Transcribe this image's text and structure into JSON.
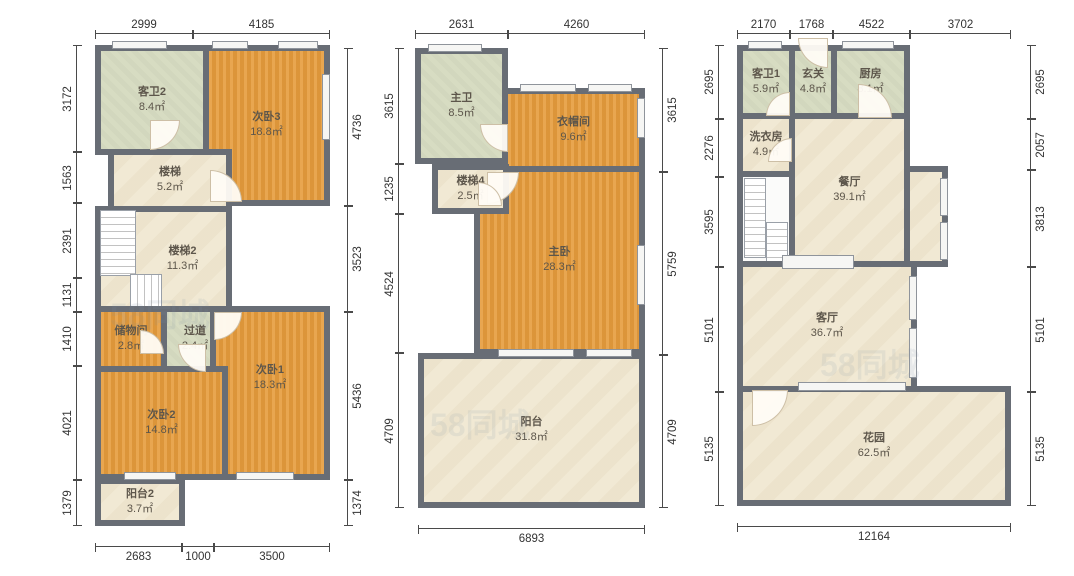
{
  "watermark": "58同城",
  "colors": {
    "wall": "#686d75",
    "bedroom": "#e69c3c",
    "bath": "#d7dcc2",
    "living": "#f1e9d4",
    "dim_text": "#333333"
  },
  "plans": [
    {
      "name": "left-floor",
      "rooms": [
        {
          "name": "客卫2",
          "area": "8.4㎡"
        },
        {
          "name": "次卧3",
          "area": "18.8㎡"
        },
        {
          "name": "楼梯",
          "area": "5.2㎡"
        },
        {
          "name": "楼梯2",
          "area": "11.3㎡"
        },
        {
          "name": "储物间",
          "area": "2.8㎡"
        },
        {
          "name": "过道",
          "area": "2.4㎡"
        },
        {
          "name": "次卧1",
          "area": "18.3㎡"
        },
        {
          "name": "次卧2",
          "area": "14.8㎡"
        },
        {
          "name": "阳台2",
          "area": "3.7㎡"
        }
      ],
      "dims": {
        "top": [
          "2999",
          "4185"
        ],
        "left": [
          "3172",
          "1563",
          "2391",
          "1131",
          "1410",
          "4021",
          "1379"
        ],
        "right": [
          "4736",
          "3523",
          "5436",
          "1374"
        ],
        "bottom": [
          "2683",
          "1000",
          "3500"
        ]
      }
    },
    {
      "name": "middle-floor",
      "rooms": [
        {
          "name": "主卫",
          "area": "8.5㎡"
        },
        {
          "name": "衣帽间",
          "area": "9.6㎡"
        },
        {
          "name": "主卧",
          "area": "28.3㎡"
        },
        {
          "name": "楼梯4",
          "area": "2.5㎡"
        },
        {
          "name": "阳台",
          "area": "31.8㎡"
        }
      ],
      "dims": {
        "top": [
          "2631",
          "4260"
        ],
        "left": [
          "3615",
          "1235",
          "4524",
          "4709"
        ],
        "right": [
          "3615",
          "5759",
          "4709"
        ],
        "bottom": [
          "6893"
        ]
      }
    },
    {
      "name": "right-floor",
      "rooms": [
        {
          "name": "客卫1",
          "area": "5.9㎡"
        },
        {
          "name": "玄关",
          "area": "4.8㎡"
        },
        {
          "name": "厨房",
          "area": "8.1㎡"
        },
        {
          "name": "洗衣房",
          "area": "4.9㎡"
        },
        {
          "name": "餐厅",
          "area": "39.1㎡"
        },
        {
          "name": "客厅",
          "area": "36.7㎡"
        },
        {
          "name": "花园",
          "area": "62.5㎡"
        }
      ],
      "dims": {
        "top": [
          "2170",
          "1768",
          "4522",
          "3702"
        ],
        "left": [
          "2695",
          "2276",
          "3595",
          "5101",
          "5135"
        ],
        "right": [
          "2695",
          "2057",
          "3813",
          "5101",
          "5135"
        ],
        "bottom": [
          "12164"
        ]
      }
    }
  ]
}
